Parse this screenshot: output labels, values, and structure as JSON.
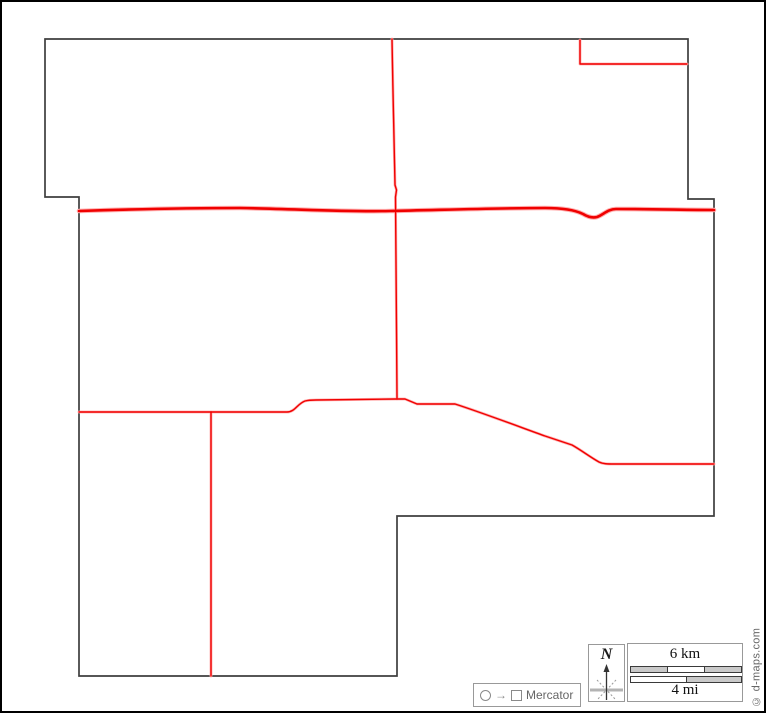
{
  "frame": {
    "border_color": "#000000",
    "background": "#ffffff"
  },
  "map": {
    "outline_color": "#3e3e3e",
    "road_color": "#f00000",
    "road_halo_color": "#ffafaf",
    "outline_path": "M45,39 L688,39 L688,199 L714,199 L714,516 L397,516 L397,676 L79,676 L79,197 L45,197 Z",
    "roads": {
      "major_highway": "M79,211 C140,209 190,208 240,208 C300,209 340,212 390,211 C440,210 500,208 545,208 C562,208 575,210 583,214 C588,217 593,218 597,217 C603,215 608,209 616,209 C650,209 690,210 714,210",
      "north_south_road": "M392,39 C393,90 394,155 395,185 L396.5,190 L395.5,197 C396,250 396.5,330 397,398",
      "west_east_road": "M79,412 L287,412 C295,412 297,404 305,401 C309,400 312,400 316,400 L397,399",
      "junction_southeast_road": "M397,399 L405,399 L417,404 L455,404 C480,412 520,427 545,436 L572,445 C581,450 590,457 599,462 C603,464 608,464 614,464 L714,464",
      "south_road": "M211,412 L211,676",
      "northeast_boundary": "M580,40 L580,64 L687,64"
    }
  },
  "north_indicator": {
    "label": "N"
  },
  "scale_bar": {
    "km_label": "6 km",
    "mi_label": "4 mi",
    "km_segments": 3,
    "mi_segments": 2,
    "segment_fill": "#c9c9c9"
  },
  "projection": {
    "label": "Mercator"
  },
  "credit": {
    "label": "© d-maps.com"
  }
}
